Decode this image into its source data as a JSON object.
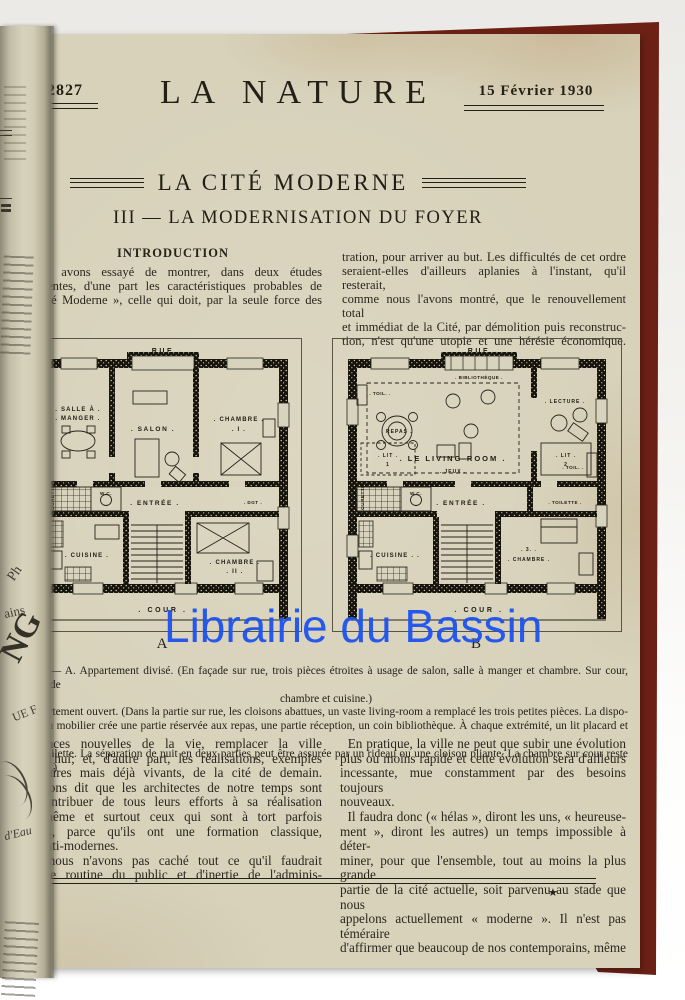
{
  "watermark": {
    "text": "Librairie du Bassin",
    "color": "#1d53ee"
  },
  "header": {
    "issue_number": "N° 2827",
    "journal_title": "LA NATURE",
    "date": "15 Février 1930"
  },
  "article": {
    "series_title": "LA CITÉ MODERNE",
    "subtitle": "III — LA MODERNISATION DU FOYER",
    "intro_heading": "INTRODUCTION",
    "intro_left_lines": [
      "Nous avons essayé de montrer, dans deux études",
      "écédentes, d'une part les caractéristiques probables de",
      "« Cité Moderne », celle qui doit, par la seule force des"
    ],
    "intro_right_lines": [
      "tration, pour arriver au but. Les difficultés de cet ordre",
      "seraient-elles d'ailleurs aplanies à l'instant, qu'il resterait,",
      "comme nous l'avons montré, que le renouvellement total",
      "et immédiat de la Cité, par démolition puis reconstruc-",
      "tion, n'est qu'une utopie et une hérésie économique."
    ]
  },
  "figure": {
    "plan_a": {
      "street": ". RUE .",
      "cour": ". COUR .",
      "letter": "A",
      "rooms": {
        "salle_1": ". SALLE À .",
        "salle_2": ". MANGER .",
        "salon": ". SALON .",
        "chambre1_1": ". CHAMBRE .",
        "chambre1_2": ". I .",
        "entree": ". ENTRÉE .",
        "degagement": ". DGT .",
        "wc": "W.C.",
        "courette": "COURETTE",
        "cuisine": ". CUISINE .",
        "chambre2_1": ". CHAMBRE .",
        "chambre2_2": ". II ."
      }
    },
    "plan_b": {
      "street": ". RUE .",
      "cour": ". COUR .",
      "letter": "B",
      "rooms": {
        "bibliotheque": ". BIBLIOTHÈQUE .",
        "repas": ". REPAS .",
        "living": ". LE  LIVING-ROOM .",
        "lecture": ". LECTURE .",
        "toil_left": ". TOIL. .",
        "toil_right": ". TOIL. .",
        "lit1_1": ". LIT .",
        "lit1_2": "1",
        "lit2_1": ". LIT .",
        "lit2_2": "2",
        "jeux": ". JEUX .",
        "entree": ". ENTRÉE .",
        "toilette": ". TOILETTE .",
        "wc": "W.C.",
        "courette": "COURETTE",
        "cuisine": ". CUISINE . .",
        "chambre3_1": ". 3. .",
        "chambre3_2": ". CHAMBRE ."
      }
    },
    "caption_lines": [
      "g. 1. — A. Appartement divisé. (En façade sur rue, trois pièces étroites à usage de salon, salle à manger et chambre. Sur cour, seconde",
      "chambre et cuisine.)",
      "Appartement ouvert. (Dans la partie sur rue, les cloisons abattues, un vaste living-room a remplacé les trois petites pièces. La dispo-",
      "ion du mobilier crée une partie réservée aux repas, une partie réception, un coin bibliothèque. À chaque extrémité, un lit placard et un",
      "ard-toilette. La séparation de nuit en deux parties peut être assurée par un rideau ou une cloison pliante. La chambre sur cour reste isolée.)"
    ]
  },
  "body": {
    "left_lines": [
      "ingences nouvelles de la vie, remplacer la ville",
      "jourd'hui; et, d'autre part, les réalisations, exemples",
      "nentaires mais déjà vivants, de la cité de demain.",
      "s avons dit que les architectes de notre temps sont",
      "à contribuer de tous leurs efforts à sa réalisation",
      "e, même et surtout ceux qui sont à tort parfois",
      "dérés, parce qu'ils ont une formation classique,",
      "ne anti-modernes.",
      "uis nous n'avons pas caché tout ce qu'il faudrait",
      "re de routine du public et d'inertie de l'adminis-"
    ],
    "right_lines": [
      "  En pratique, la ville ne peut que subir une évolution",
      "plus ou moins rapide et cette évolution sera d'ailleurs",
      "incessante, mue constamment par des besoins toujours",
      "nouveaux.",
      "  Il faudra donc (« hélas », diront les uns, « heureuse-",
      "ment », diront les autres) un temps impossible à déter-",
      "miner, pour que l'ensemble, tout au moins la plus grande",
      "partie de la cité actuelle, soit parvenu au stade que nous",
      "appelons actuellement « moderne ». Il n'est pas téméraire",
      "d'affirmer que beaucoup de nos contemporains, même"
    ]
  },
  "footer": {
    "star": "★"
  },
  "spine": {
    "fragments": [
      "Ph",
      "ains",
      "NG",
      "UE F",
      "d'Eau"
    ]
  }
}
